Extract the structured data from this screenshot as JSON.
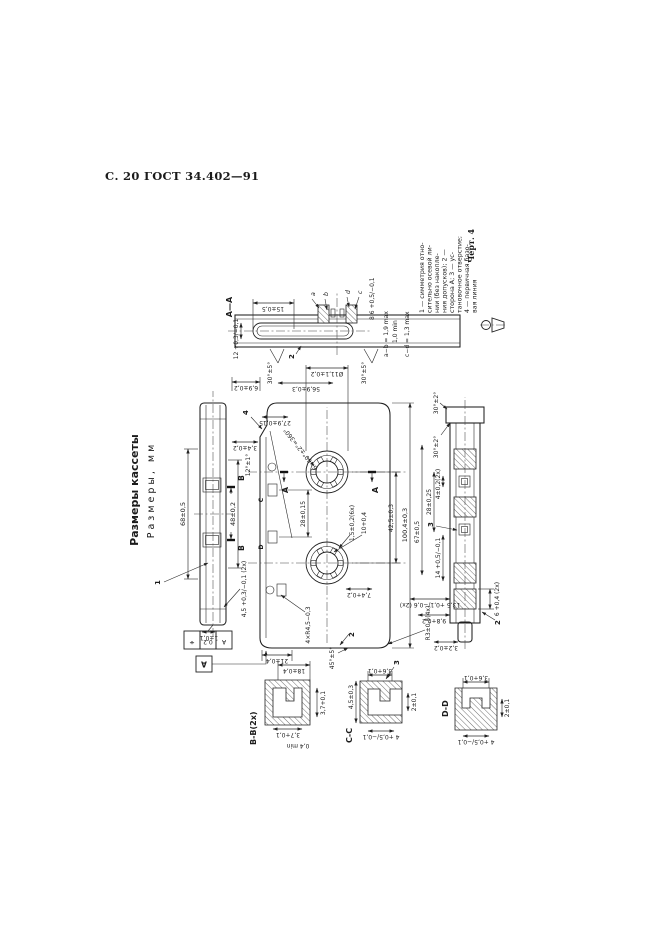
{
  "page": {
    "header": "С. 20 ГОСТ 34.402—91",
    "figure": "Черт. 4"
  },
  "title": {
    "line1": "Размеры кассеты",
    "line2": "Размеры, мм"
  },
  "legend": {
    "l1": "1 — симметрия отно-",
    "l2": "сительно осевой ли-",
    "l3": "нии (без накопле-",
    "l4": "ния допусков); 2 —",
    "l5": "сторона А; 3 — ус-",
    "l6": "тановочное отверстие;",
    "l7": "4 — первичная базо-",
    "l8": "вая линия"
  },
  "edge_top": {
    "d68": "68±0,5",
    "d48": "48±0,2",
    "d45": "4,5 +0,3/−0,1 (2х)",
    "d1": "1±0,1",
    "b1": "B",
    "b2": "B",
    "ref1": "1",
    "fcf_sym": "⌖",
    "fcf_tol": "0,2",
    "fcf_datum": "А",
    "datum": "А"
  },
  "main": {
    "d1004": "100,4±0,3",
    "d67": "67±0,5",
    "d2825": "28±0,25",
    "d425": "42,5±0,3",
    "d2815": "28±0,15",
    "d569": "56,9±0,3",
    "d69": "6,9±0,2",
    "d279": "27,9±0,15",
    "d111": "Ø11,1±0,2",
    "d34": "3,4±0,2",
    "a12": "12°±1°",
    "teeth": "6×60°±2°=360°",
    "d15": "1,5±0,2(6х)",
    "d10": "10+0,4",
    "d74": "7,4+0,2",
    "r3": "R3±0,5(4х)",
    "r45": "4×R4,5−0,3",
    "d21": "21±0,4",
    "a45": "45°±5°",
    "ref2": "2",
    "ref4": "4",
    "secA1": "А",
    "secA2": "А",
    "c": "C",
    "d": "D"
  },
  "aa": {
    "label": "А—А",
    "d12": "12 +0,3/−0,1",
    "d15": "15±0,5",
    "a30a": "30°±5°",
    "a30b": "30°±5°",
    "d86": "8,6 +0,5/−0,1",
    "f1": "a−b = 1,9 max",
    "f2": "1,0 min",
    "f3": "c−d = 1,3 max",
    "la": "a",
    "lb": "b",
    "lc": "c",
    "ld": "d",
    "ref2": "2"
  },
  "bb": {
    "label": "В-В(2х)",
    "d37a": "3,7+0,1",
    "d37b": "3,7+0,1",
    "dmin": "0,4 min",
    "d18": "18±0,4"
  },
  "cc": {
    "label": "С-С",
    "d45": "4,5±0,3",
    "d36": "3,6+0,1",
    "d4": "4 +0,5/−0,1",
    "d2": "2±0,1",
    "ref3": "3"
  },
  "dd": {
    "label": "D-D",
    "d4": "4 +0,5/−0,1",
    "d36": "3,6+0,1",
    "d2": "2±0,1"
  },
  "edge_bottom": {
    "a30a": "30°±2°",
    "a30b": "30°±2°",
    "d4": "4±0,2(2х)",
    "d14": "14 +0,5/−0,1",
    "d6": "6 +0,4 (2х)",
    "d135": "13,5 +0,1/−0,6 (2х)",
    "d98": "9,8+0,2",
    "d32": "3,2±0,2",
    "ref2": "2",
    "ref3": "3"
  }
}
